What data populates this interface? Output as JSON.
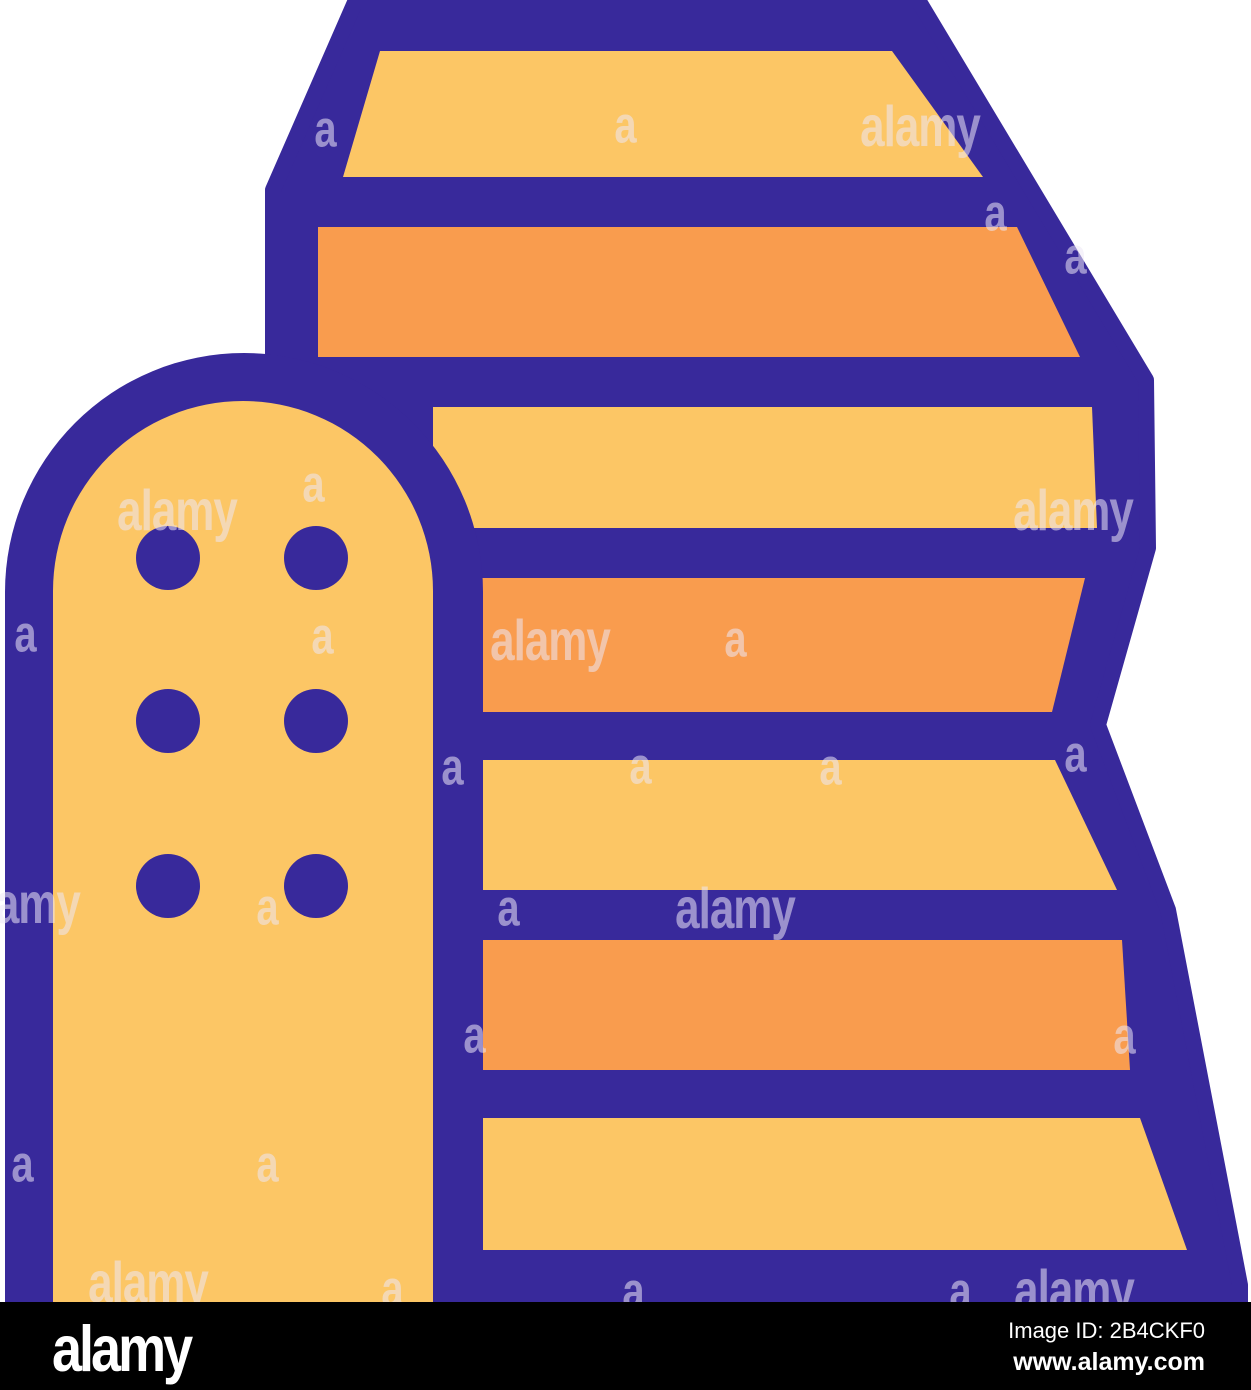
{
  "colors": {
    "outline_purple": "#38299B",
    "stripe_yellow": "#FCC665",
    "stripe_orange": "#F99C4E",
    "canvas_white": "#FFFFFF",
    "footer_black": "#000000",
    "footer_text_white": "#FFFFFF",
    "watermark_tint": "rgba(236,232,246,0.55)"
  },
  "icon": {
    "name": "striped hay stack with rounded tower building, flat outline vector icon",
    "stripe_colors": [
      "#FCC665",
      "#F99C4E",
      "#FCC665",
      "#F99C4E",
      "#FCC665",
      "#F99C4E",
      "#FCC665"
    ],
    "tower_fill": "#FCC665",
    "tower_dot_count": 6
  },
  "watermarks": {
    "brand_text": "alamy",
    "letter": "a",
    "alamy_positions": [
      {
        "x": 177,
        "y": 512
      },
      {
        "x": 920,
        "y": 128
      },
      {
        "x": 550,
        "y": 642
      },
      {
        "x": 735,
        "y": 910
      },
      {
        "x": 148,
        "y": 1284
      },
      {
        "x": 1073,
        "y": 512
      },
      {
        "x": 1074,
        "y": 1292
      },
      {
        "x": 20,
        "y": 905
      }
    ],
    "letter_positions": [
      {
        "x": 325,
        "y": 130
      },
      {
        "x": 625,
        "y": 126
      },
      {
        "x": 995,
        "y": 214
      },
      {
        "x": 1075,
        "y": 257
      },
      {
        "x": 313,
        "y": 485
      },
      {
        "x": 25,
        "y": 635
      },
      {
        "x": 322,
        "y": 637
      },
      {
        "x": 735,
        "y": 640
      },
      {
        "x": 452,
        "y": 768
      },
      {
        "x": 640,
        "y": 767
      },
      {
        "x": 830,
        "y": 768
      },
      {
        "x": 1075,
        "y": 755
      },
      {
        "x": 267,
        "y": 908
      },
      {
        "x": 508,
        "y": 909
      },
      {
        "x": 474,
        "y": 1036
      },
      {
        "x": 1124,
        "y": 1037
      },
      {
        "x": 22,
        "y": 1165
      },
      {
        "x": 267,
        "y": 1165
      },
      {
        "x": 392,
        "y": 1290
      },
      {
        "x": 633,
        "y": 1292
      },
      {
        "x": 960,
        "y": 1292
      }
    ]
  },
  "footer": {
    "logo_text": "alamy",
    "image_id_label": "Image ID: 2B4CKF0",
    "website": "www.alamy.com"
  }
}
